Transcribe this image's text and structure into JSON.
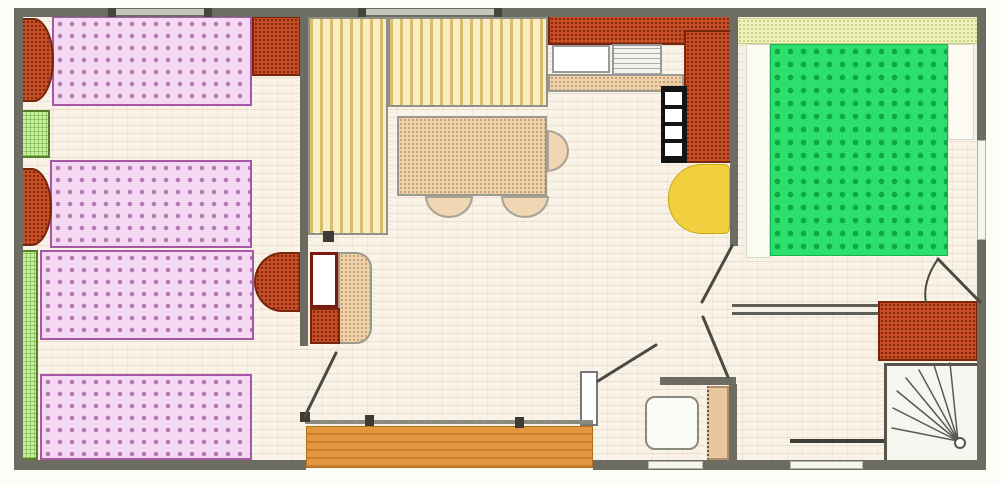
{
  "meta": {
    "type": "floor-plan",
    "canvas": {
      "w": 1000,
      "h": 486
    }
  },
  "palette": {
    "wall": "#6c6c63",
    "floor": "#f8f3e6",
    "bed_pink": "#f5d9f3",
    "bed_pink_border": "#a657a5",
    "pillow_counter_orange": "#c94f26",
    "bed_green": "#2de06e",
    "sofa_yellow": "#f8edc4",
    "deck_orange": "#e2973f",
    "fridge_yellow": "#f2cf3e",
    "green_furniture": "#c9ee9f",
    "tan": "#eed2ab",
    "headboard": "#eef3bc",
    "door_tan": "#e7c79e"
  },
  "elements": [
    {
      "name": "floor",
      "cls": "floor",
      "x": 22,
      "y": 16,
      "w": 956,
      "h": 446
    },
    {
      "name": "terrace-deck",
      "cls": "deck",
      "x": 306,
      "y": 426,
      "w": 287,
      "h": 42
    },
    {
      "name": "bed-single-a",
      "cls": "bed-pink",
      "x": 52,
      "y": 16,
      "w": 200,
      "h": 90
    },
    {
      "name": "bed-single-a-pillow",
      "cls": "speckle-orange",
      "x": 20,
      "y": 18,
      "w": 34,
      "h": 84,
      "r": "0 60% 60% 0 / 0 50% 50% 0"
    },
    {
      "name": "nightstand-green",
      "cls": "green-check",
      "x": 16,
      "y": 110,
      "w": 34,
      "h": 48
    },
    {
      "name": "corner-wardrobe",
      "cls": "speckle-orange",
      "x": 252,
      "y": 16,
      "w": 49,
      "h": 60
    },
    {
      "name": "bed-single-b",
      "cls": "bed-pink",
      "x": 50,
      "y": 160,
      "w": 202,
      "h": 88
    },
    {
      "name": "bed-single-b-pillow",
      "cls": "speckle-orange",
      "x": 18,
      "y": 168,
      "w": 34,
      "h": 78,
      "r": "0 60% 60% 0 / 0 50% 50% 0"
    },
    {
      "name": "bed-single-c",
      "cls": "bed-pink",
      "x": 40,
      "y": 250,
      "w": 214,
      "h": 90
    },
    {
      "name": "bed-single-c-pillow",
      "cls": "speckle-orange",
      "x": 254,
      "y": 252,
      "w": 47,
      "h": 60,
      "r": "60% 0 0 60% / 50% 0 0 50%"
    },
    {
      "name": "wardrobe-shelf-strip",
      "cls": "green-check",
      "x": 16,
      "y": 250,
      "w": 22,
      "h": 210
    },
    {
      "name": "bed-single-d",
      "cls": "bed-pink",
      "x": 40,
      "y": 374,
      "w": 212,
      "h": 86
    },
    {
      "name": "sofa-l-vertical",
      "cls": "sofa",
      "x": 308,
      "y": 17,
      "w": 80,
      "h": 218
    },
    {
      "name": "sofa-l-horizontal",
      "cls": "sofa",
      "x": 388,
      "y": 17,
      "w": 160,
      "h": 90
    },
    {
      "name": "dining-table",
      "cls": "tan-speckle",
      "x": 397,
      "y": 116,
      "w": 150,
      "h": 80
    },
    {
      "name": "chair-1",
      "cls": "chair",
      "x": 425,
      "y": 196,
      "w": 48,
      "h": 22,
      "r": "0 0 24px 24px / 0 0 22px 22px"
    },
    {
      "name": "chair-2",
      "cls": "chair",
      "x": 501,
      "y": 196,
      "w": 48,
      "h": 22,
      "r": "0 0 24px 24px / 0 0 22px 22px"
    },
    {
      "name": "chair-3",
      "cls": "chair",
      "x": 547,
      "y": 130,
      "w": 22,
      "h": 42,
      "r": "0 22px 22px 0 / 0 21px 21px 0"
    },
    {
      "name": "tv-cabinet-back",
      "cls": "tan-speckle",
      "x": 338,
      "y": 252,
      "w": 34,
      "h": 92,
      "r": "0 16px 16px 0"
    },
    {
      "name": "tv-screen",
      "cls": "tv",
      "x": 310,
      "y": 252,
      "w": 28,
      "h": 56
    },
    {
      "name": "tv-cabinet-base",
      "cls": "speckle-orange",
      "x": 310,
      "y": 308,
      "w": 30,
      "h": 36
    },
    {
      "name": "kitchen-counter-top",
      "cls": "speckle-orange",
      "x": 548,
      "y": 15,
      "w": 186,
      "h": 30
    },
    {
      "name": "kitchen-counter-right",
      "cls": "speckle-orange",
      "x": 684,
      "y": 30,
      "w": 50,
      "h": 133
    },
    {
      "name": "kitchen-counter-edge",
      "cls": "tan-speckle",
      "x": 548,
      "y": 74,
      "w": 136,
      "h": 18
    },
    {
      "name": "sink-basin",
      "cls": "sink",
      "x": 552,
      "y": 45,
      "w": 58,
      "h": 28
    },
    {
      "name": "sink-drainer",
      "cls": "drainer",
      "x": 612,
      "y": 44,
      "w": 50,
      "h": 32
    },
    {
      "name": "stove",
      "cls": "stove",
      "x": 661,
      "y": 86,
      "w": 26,
      "h": 77
    },
    {
      "name": "stove-burner-1",
      "cls": "burner",
      "x": 665,
      "y": 92,
      "w": 17,
      "h": 13
    },
    {
      "name": "stove-burner-2",
      "cls": "burner",
      "x": 665,
      "y": 109,
      "w": 17,
      "h": 13
    },
    {
      "name": "stove-burner-3",
      "cls": "burner",
      "x": 665,
      "y": 126,
      "w": 17,
      "h": 13
    },
    {
      "name": "stove-burner-4",
      "cls": "burner",
      "x": 665,
      "y": 143,
      "w": 17,
      "h": 13
    },
    {
      "name": "fridge",
      "cls": "fridge",
      "x": 668,
      "y": 164,
      "w": 62,
      "h": 70,
      "r": "34px 6px 6px 34px / 34px 6px 6px 34px"
    },
    {
      "name": "headboard-shelf",
      "cls": "headboard",
      "x": 737,
      "y": 18,
      "w": 241,
      "h": 26
    },
    {
      "name": "bedside-strip-left",
      "cls": "white-area",
      "x": 746,
      "y": 44,
      "w": 24,
      "h": 214
    },
    {
      "name": "bedside-strip-right",
      "cls": "white-area",
      "x": 948,
      "y": 44,
      "w": 26,
      "h": 96
    },
    {
      "name": "bed-double-green",
      "cls": "bed-green",
      "x": 770,
      "y": 44,
      "w": 178,
      "h": 212
    },
    {
      "name": "bathroom-vanity",
      "cls": "speckle-orange",
      "x": 878,
      "y": 301,
      "w": 100,
      "h": 60
    },
    {
      "name": "shower-tray",
      "cls": "shower",
      "x": 884,
      "y": 363,
      "w": 98,
      "h": 100
    },
    {
      "name": "toilet",
      "cls": "toilet",
      "x": 645,
      "y": 396,
      "w": 54,
      "h": 54,
      "r": "10px"
    },
    {
      "name": "wc-door-panel",
      "cls": "door-tan",
      "x": 707,
      "y": 386,
      "w": 22,
      "h": 74
    },
    {
      "name": "wall-top",
      "cls": "wall",
      "x": 14,
      "y": 8,
      "w": 972,
      "h": 9
    },
    {
      "name": "wall-left",
      "cls": "wall",
      "x": 14,
      "y": 8,
      "w": 9,
      "h": 462
    },
    {
      "name": "wall-right",
      "cls": "wall",
      "x": 977,
      "y": 8,
      "w": 9,
      "h": 462
    },
    {
      "name": "wall-bottom-left",
      "cls": "wall",
      "x": 14,
      "y": 460,
      "w": 292,
      "h": 10
    },
    {
      "name": "wall-bottom-right",
      "cls": "wall",
      "x": 593,
      "y": 460,
      "w": 393,
      "h": 10
    },
    {
      "name": "wall-partition-left-bedroom",
      "cls": "wall",
      "x": 300,
      "y": 14,
      "w": 8,
      "h": 332
    },
    {
      "name": "wall-kitchen",
      "cls": "wall",
      "x": 730,
      "y": 14,
      "w": 8,
      "h": 232
    },
    {
      "name": "wall-bedroom-bathroom",
      "cls": "wall-double",
      "x": 732,
      "y": 304,
      "w": 146,
      "h": 11
    },
    {
      "name": "wall-wc-top",
      "cls": "wall",
      "x": 660,
      "y": 377,
      "w": 76,
      "h": 8
    },
    {
      "name": "wall-wc-right",
      "cls": "wall",
      "x": 729,
      "y": 384,
      "w": 8,
      "h": 78
    },
    {
      "name": "bay-pier",
      "cls": "pier",
      "x": 580,
      "y": 371,
      "w": 18,
      "h": 55
    },
    {
      "name": "bay-window-sill",
      "cls": "sill",
      "x": 305,
      "y": 420,
      "w": 288,
      "h": 4
    },
    {
      "name": "bay-handle-1",
      "cls": "mark",
      "x": 365,
      "y": 415,
      "w": 9,
      "h": 11
    },
    {
      "name": "bay-handle-2",
      "cls": "mark",
      "x": 515,
      "y": 417,
      "w": 9,
      "h": 11
    },
    {
      "name": "door-hinge-block",
      "cls": "mark",
      "x": 300,
      "y": 412,
      "w": 10,
      "h": 10
    },
    {
      "name": "sofa-end-mark",
      "cls": "mark",
      "x": 323,
      "y": 231,
      "w": 11,
      "h": 11
    },
    {
      "name": "bathroom-rail",
      "cls": "sill-dark",
      "x": 790,
      "y": 439,
      "w": 94,
      "h": 4
    },
    {
      "name": "window-right-wall",
      "cls": "window",
      "x": 977,
      "y": 140,
      "w": 9,
      "h": 100
    },
    {
      "name": "window-bottom-1",
      "cls": "window",
      "x": 648,
      "y": 461,
      "w": 55,
      "h": 8
    },
    {
      "name": "window-bottom-2",
      "cls": "window",
      "x": 790,
      "y": 461,
      "w": 73,
      "h": 8
    },
    {
      "name": "window-top-1",
      "cls": "window-top",
      "x": 116,
      "y": 9,
      "w": 90,
      "h": 6
    },
    {
      "name": "window-top-2",
      "cls": "window-top",
      "x": 366,
      "y": 9,
      "w": 130,
      "h": 6
    },
    {
      "name": "wall-tick-1",
      "cls": "tick",
      "x": 108,
      "y": 8,
      "w": 8,
      "h": 9
    },
    {
      "name": "wall-tick-2",
      "cls": "tick",
      "x": 204,
      "y": 8,
      "w": 8,
      "h": 9
    },
    {
      "name": "wall-tick-3",
      "cls": "tick",
      "x": 358,
      "y": 8,
      "w": 8,
      "h": 9
    },
    {
      "name": "wall-tick-4",
      "cls": "tick",
      "x": 494,
      "y": 8,
      "w": 8,
      "h": 9
    }
  ],
  "overlay": {
    "lines": [
      {
        "name": "door-leaf-left-bedroom",
        "cls": "door",
        "x1": 305,
        "y1": 416,
        "x2": 336,
        "y2": 353
      },
      {
        "name": "door-leaf-entrance",
        "cls": "door",
        "x1": 598,
        "y1": 381,
        "x2": 656,
        "y2": 345
      },
      {
        "name": "door-leaf-hall-upper",
        "cls": "door",
        "x1": 732,
        "y1": 246,
        "x2": 702,
        "y2": 302
      },
      {
        "name": "door-leaf-hall-lower",
        "cls": "door",
        "x1": 703,
        "y1": 317,
        "x2": 728,
        "y2": 377
      },
      {
        "name": "door-leaf-bathroom",
        "cls": "door",
        "x1": 938,
        "y1": 259,
        "x2": 980,
        "y2": 302
      },
      {
        "name": "shower-spray-1",
        "cls": "spray",
        "x1": 958,
        "y1": 441,
        "x2": 892,
        "y2": 428
      },
      {
        "name": "shower-spray-2",
        "cls": "spray",
        "x1": 958,
        "y1": 441,
        "x2": 893,
        "y2": 408
      },
      {
        "name": "shower-spray-3",
        "cls": "spray",
        "x1": 958,
        "y1": 441,
        "x2": 897,
        "y2": 391
      },
      {
        "name": "shower-spray-4",
        "cls": "spray",
        "x1": 958,
        "y1": 441,
        "x2": 906,
        "y2": 378
      },
      {
        "name": "shower-spray-5",
        "cls": "spray",
        "x1": 958,
        "y1": 441,
        "x2": 919,
        "y2": 370
      },
      {
        "name": "shower-spray-6",
        "cls": "spray",
        "x1": 958,
        "y1": 441,
        "x2": 934,
        "y2": 365
      },
      {
        "name": "shower-spray-7",
        "cls": "spray",
        "x1": 958,
        "y1": 441,
        "x2": 950,
        "y2": 363
      }
    ],
    "paths": [
      {
        "name": "door-arc-bathroom",
        "cls": "arc",
        "d": "M 938 259 Q 922 282 926 303"
      }
    ],
    "circles": [
      {
        "name": "shower-drain",
        "cls": "drain",
        "cx": 960,
        "cy": 443,
        "r": 5
      }
    ]
  }
}
